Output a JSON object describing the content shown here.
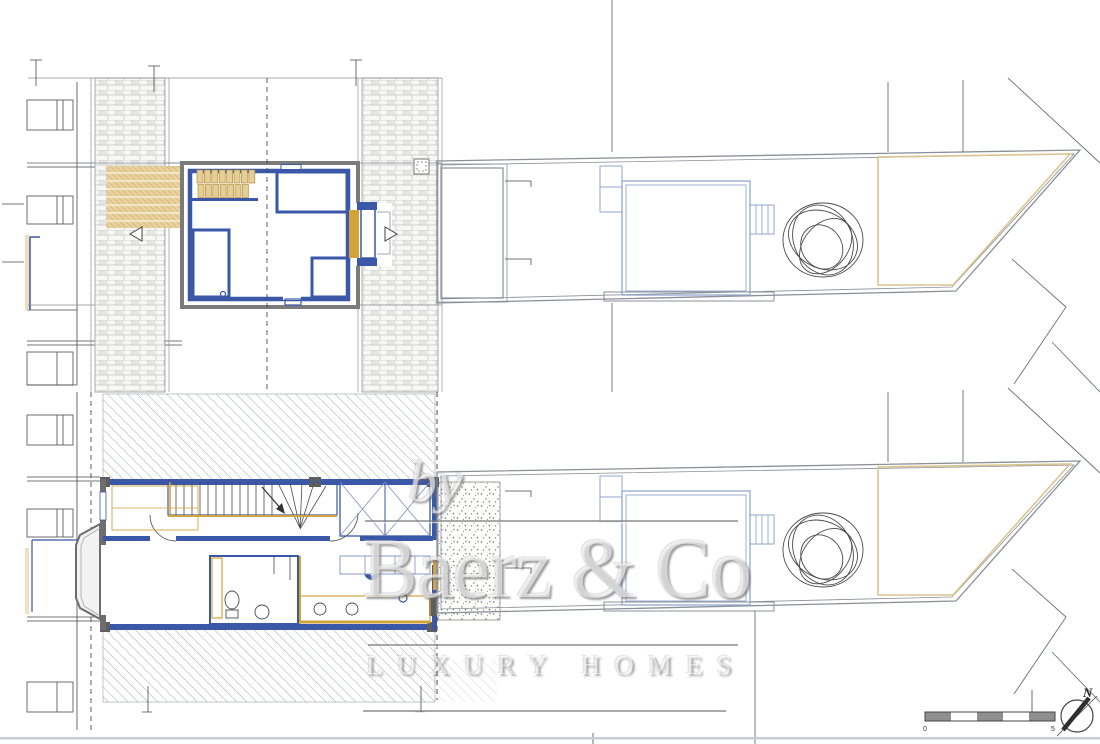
{
  "watermark": {
    "prefix": "by",
    "brand": "Baerz & Co",
    "tagline": "LUXURY HOMES"
  },
  "scale_bar": {
    "start_label": "0",
    "end_label": "5"
  },
  "compass": {
    "north_label": "N"
  },
  "palette": {
    "wall_blue": "#3a57a8",
    "wall_gray": "#7a7a7a",
    "accent_gold": "#d2a339",
    "tan_hatch": "#e6ce97",
    "line_gray": "#8a8f98",
    "brick_line": "#c3c3c1",
    "bottom_border": "#c9cdd6"
  }
}
